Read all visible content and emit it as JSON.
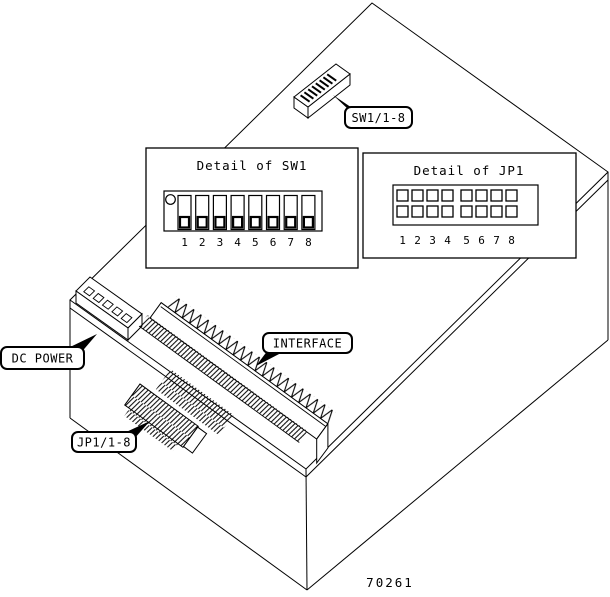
{
  "figure_number": "70261",
  "callouts": {
    "sw1": "SW1/1-8",
    "dc_power": "DC POWER",
    "interface": "INTERFACE",
    "jp1": "JP1/1-8"
  },
  "details": {
    "sw1": {
      "title": "Detail of SW1",
      "positions": [
        "1",
        "2",
        "3",
        "4",
        "5",
        "6",
        "7",
        "8"
      ]
    },
    "jp1": {
      "title": "Detail of JP1",
      "positions": [
        "1",
        "2",
        "3",
        "4",
        "5",
        "6",
        "7",
        "8"
      ]
    }
  },
  "colors": {
    "line": "#000000",
    "background": "#ffffff"
  }
}
